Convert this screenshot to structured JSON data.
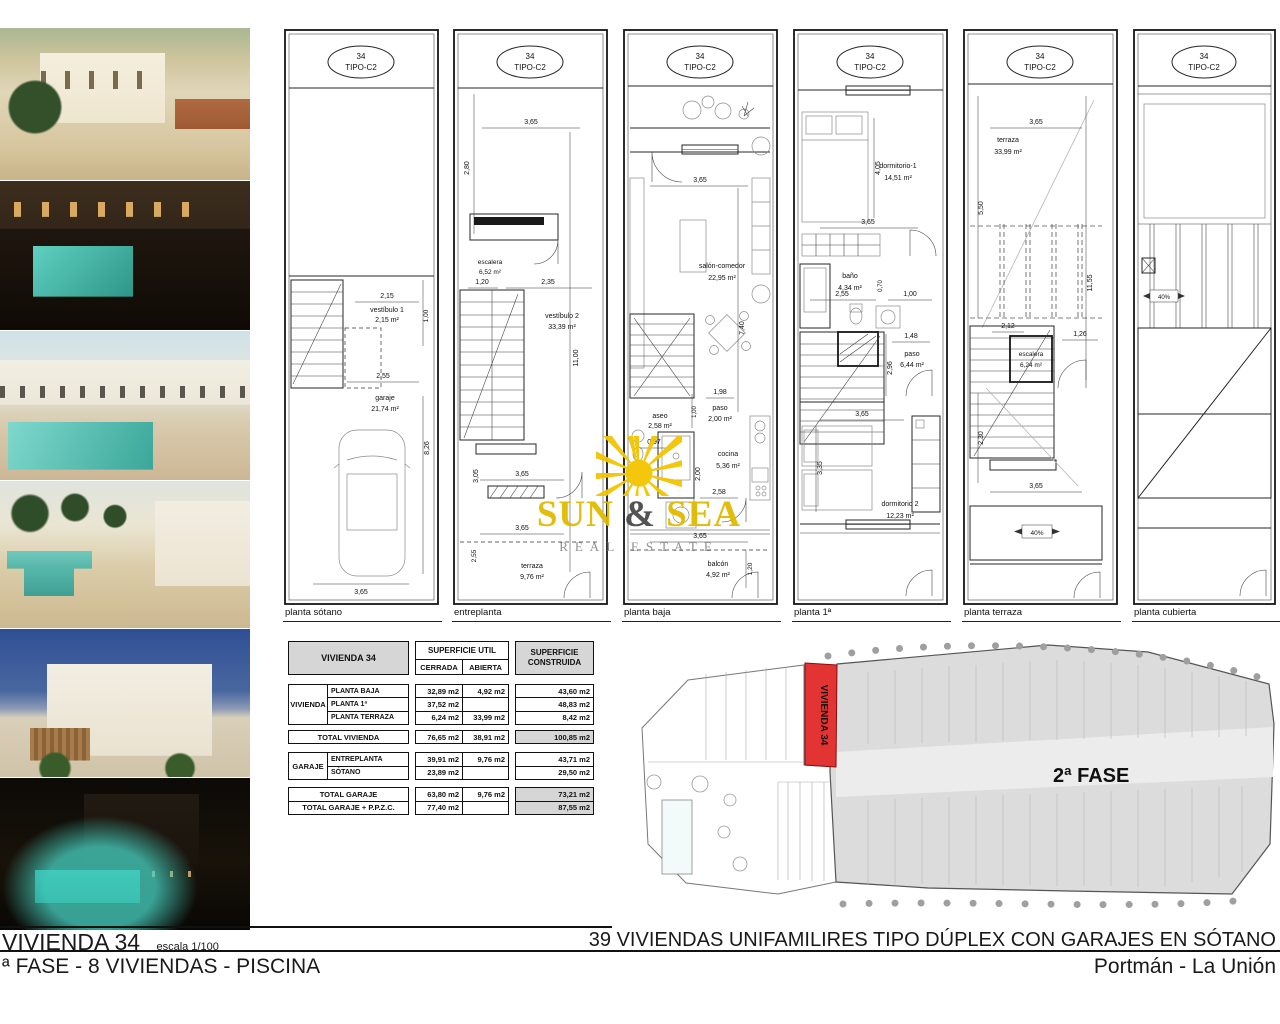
{
  "badge": {
    "number": "34",
    "type": "TIPO-C2"
  },
  "plans": [
    {
      "caption": "planta sótano",
      "rooms": [
        {
          "name": "vestíbulo 1",
          "area": "2,15 m²"
        },
        {
          "name": "garaje",
          "area": "21,74 m²"
        }
      ],
      "dims": [
        "2,15",
        "1,00",
        "2,55",
        "8,26",
        "3,65"
      ]
    },
    {
      "caption": "entreplanta",
      "rooms": [
        {
          "name": "escalera",
          "area": "6,52 m²"
        },
        {
          "name": "vestíbulo 2",
          "area": "33,39 m²"
        },
        {
          "name": "terraza",
          "area": "9,76 m²"
        }
      ],
      "dims": [
        "3,65",
        "2,80",
        "1,20",
        "2,35",
        "11,00",
        "3,05",
        "3,65",
        "3,65",
        "2,55"
      ]
    },
    {
      "caption": "planta baja",
      "rooms": [
        {
          "name": "salón-comedor",
          "area": "22,95 m²"
        },
        {
          "name": "aseo",
          "area": "2,58 m²"
        },
        {
          "name": "paso",
          "area": "2,00 m²"
        },
        {
          "name": "cocina",
          "area": "5,36 m²"
        },
        {
          "name": "balcón",
          "area": "4,92 m²"
        }
      ],
      "dims": [
        "3,65",
        "7,40",
        "1,98",
        "1,00",
        "0,97",
        "2,00",
        "2,58",
        "3,65",
        "1,20"
      ]
    },
    {
      "caption": "planta 1ª",
      "rooms": [
        {
          "name": "dormitorio-1",
          "area": "14,51 m²"
        },
        {
          "name": "baño",
          "area": "4,34 m²"
        },
        {
          "name": "paso",
          "area": "6,44 m²"
        },
        {
          "name": "dormitorio 2",
          "area": "12,23 m²"
        }
      ],
      "dims": [
        "4,05",
        "3,65",
        "2,55",
        "1,00",
        "0,70",
        "1,48",
        "2,96",
        "3,65",
        "3,35"
      ]
    },
    {
      "caption": "planta terraza",
      "rooms": [
        {
          "name": "terraza",
          "area": "33,99 m²"
        },
        {
          "name": "escalera",
          "area": "6,24 m²"
        }
      ],
      "dims": [
        "3,65",
        "5,50",
        "11,55",
        "2,12",
        "1,26",
        "2,30",
        "3,65"
      ],
      "slope": "40%"
    },
    {
      "caption": "planta cubierta",
      "rooms": [],
      "dims": [],
      "slope": "40%"
    }
  ],
  "table": {
    "title": "VIVIENDA 34",
    "header_util": "SUPERFICIE UTIL",
    "header_cerrada": "CERRADA",
    "header_abierta": "ABIERTA",
    "header_construida": "SUPERFICIE CONSTRUIDA",
    "groups": [
      {
        "name": "VIVIENDA",
        "rows": [
          {
            "label": "PLANTA BAJA",
            "cerrada": "32,89 m2",
            "abierta": "4,92 m2",
            "construida": "43,60 m2"
          },
          {
            "label": "PLANTA 1ª",
            "cerrada": "37,52 m2",
            "abierta": "",
            "construida": "48,83 m2"
          },
          {
            "label": "PLANTA TERRAZA",
            "cerrada": "6,24 m2",
            "abierta": "33,99 m2",
            "construida": "8,42 m2"
          }
        ]
      },
      {
        "name": "GARAJE",
        "rows": [
          {
            "label": "ENTREPLANTA",
            "cerrada": "39,91 m2",
            "abierta": "9,76 m2",
            "construida": "43,71 m2"
          },
          {
            "label": "SÓTANO",
            "cerrada": "23,89 m2",
            "abierta": "",
            "construida": "29,50 m2"
          }
        ]
      }
    ],
    "totals": [
      {
        "label": "TOTAL VIVIENDA",
        "cerrada": "76,65 m2",
        "abierta": "38,91 m2",
        "construida": "100,85 m2"
      },
      {
        "label": "TOTAL GARAJE",
        "cerrada": "63,80 m2",
        "abierta": "9,76 m2",
        "construida": "73,21 m2"
      },
      {
        "label": "TOTAL GARAJE + P.P.Z.C.",
        "cerrada": "77,40 m2",
        "abierta": "",
        "construida": "87,55 m2"
      }
    ]
  },
  "siteplan": {
    "phase": "2ª FASE",
    "plot": "VIVIENDA 34",
    "plot_color": "#e33434"
  },
  "watermark": {
    "word1": "SUN",
    "amp": "&",
    "word2": "SEA",
    "subtitle": "REAL ESTATE",
    "color_yellow": "#e2ba00",
    "color_gray": "#4a4a4a"
  },
  "titleblock": {
    "left_title": "VIVIENDA 34",
    "left_scale": "escala 1/100",
    "left_subtitle": "ª FASE - 8 VIVIENDAS - PISCINA",
    "right_title": "39 VIVIENDAS UNIFAMILIRES TIPO DÚPLEX CON GARAJES EN SÓTANO",
    "right_subtitle": "Portmán - La Unión"
  }
}
